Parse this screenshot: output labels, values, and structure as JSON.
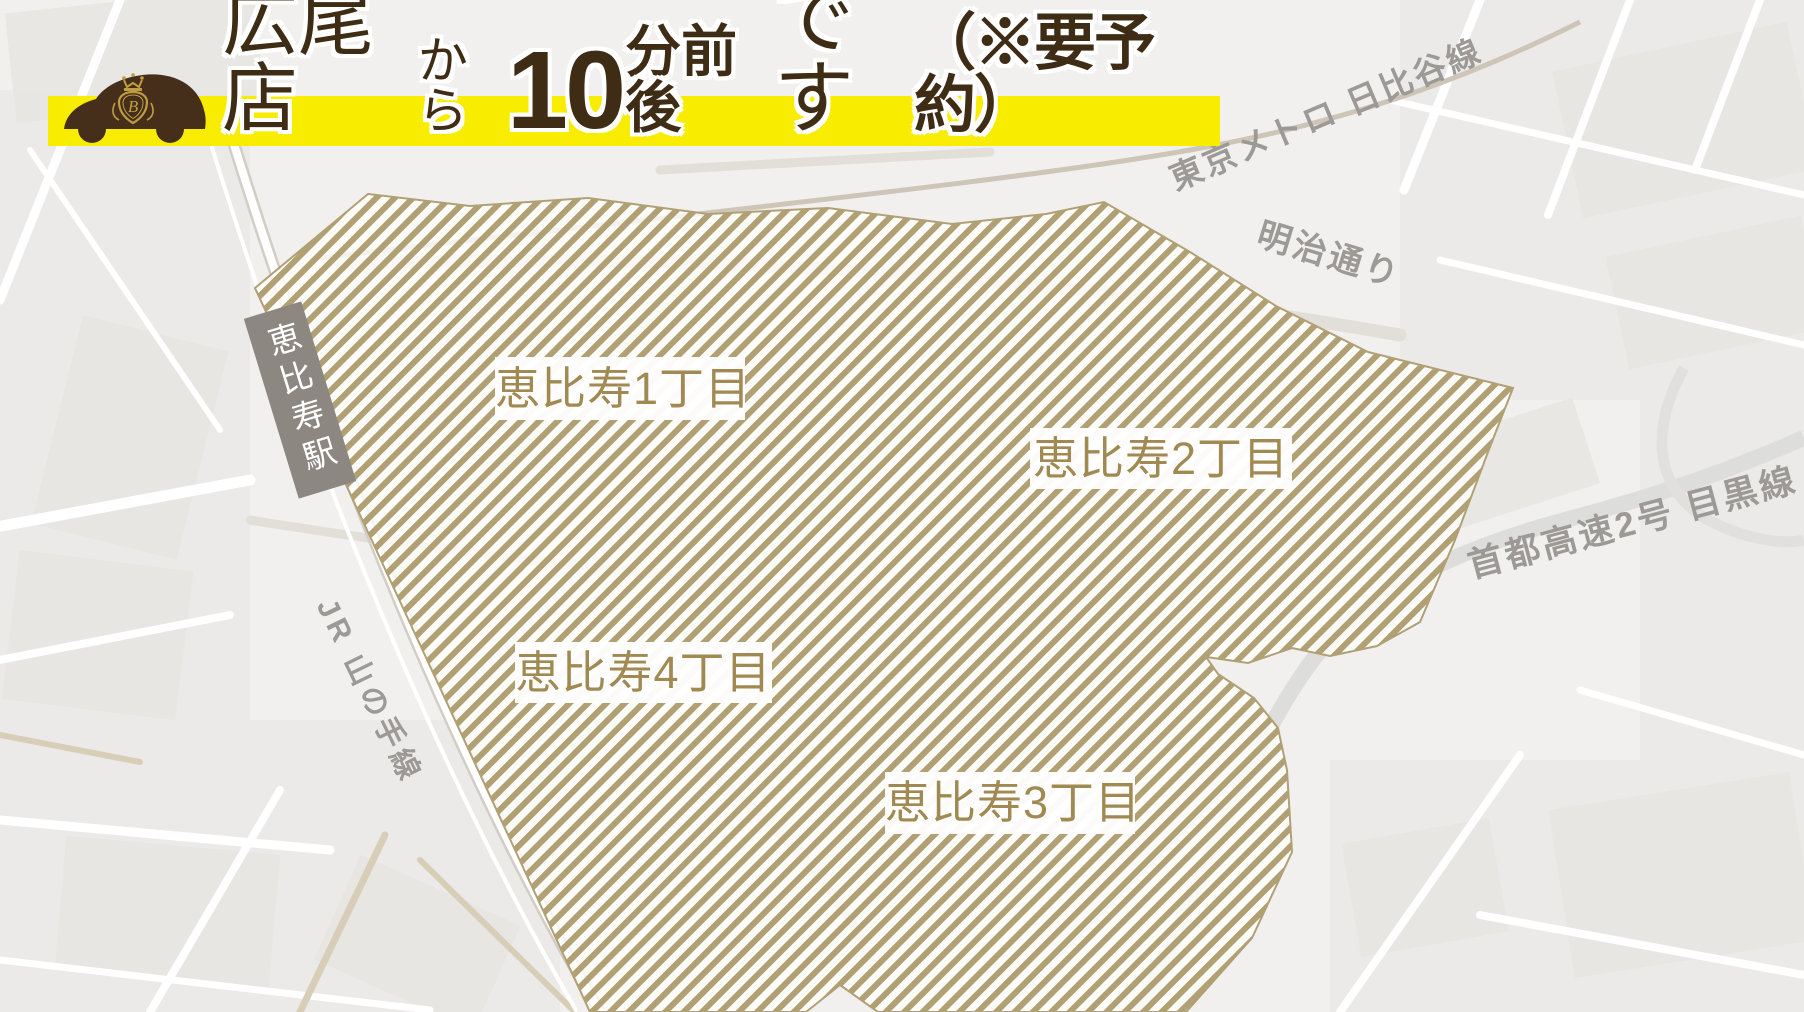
{
  "header": {
    "title_parts": [
      {
        "text": "広尾店"
      },
      {
        "text": "から"
      },
      {
        "text": "10"
      },
      {
        "text": "分前後"
      },
      {
        "text": "です"
      },
      {
        "text": "（※要予約）"
      }
    ],
    "logo_letter": "B"
  },
  "map": {
    "district_labels": [
      {
        "text": "恵比寿1丁目"
      },
      {
        "text": "恵比寿2丁目"
      },
      {
        "text": "恵比寿3丁目"
      },
      {
        "text": "恵比寿4丁目"
      }
    ],
    "station_label": {
      "text": "恵比寿駅"
    },
    "road_labels": [
      {
        "text": "東京メトロ 日比谷線"
      },
      {
        "text": "明治通り"
      },
      {
        "text": "首都高速2号 目黒線"
      },
      {
        "text": "JR 山の手線"
      }
    ]
  },
  "colors": {
    "accent_yellow": "#f8ec00",
    "brand_brown": "#3f2c15",
    "service_area_hatch": "#b1a074",
    "district_text": "#a18a52",
    "station_badge_bg": "#8d8781",
    "road_label_text": "#9c9996"
  }
}
